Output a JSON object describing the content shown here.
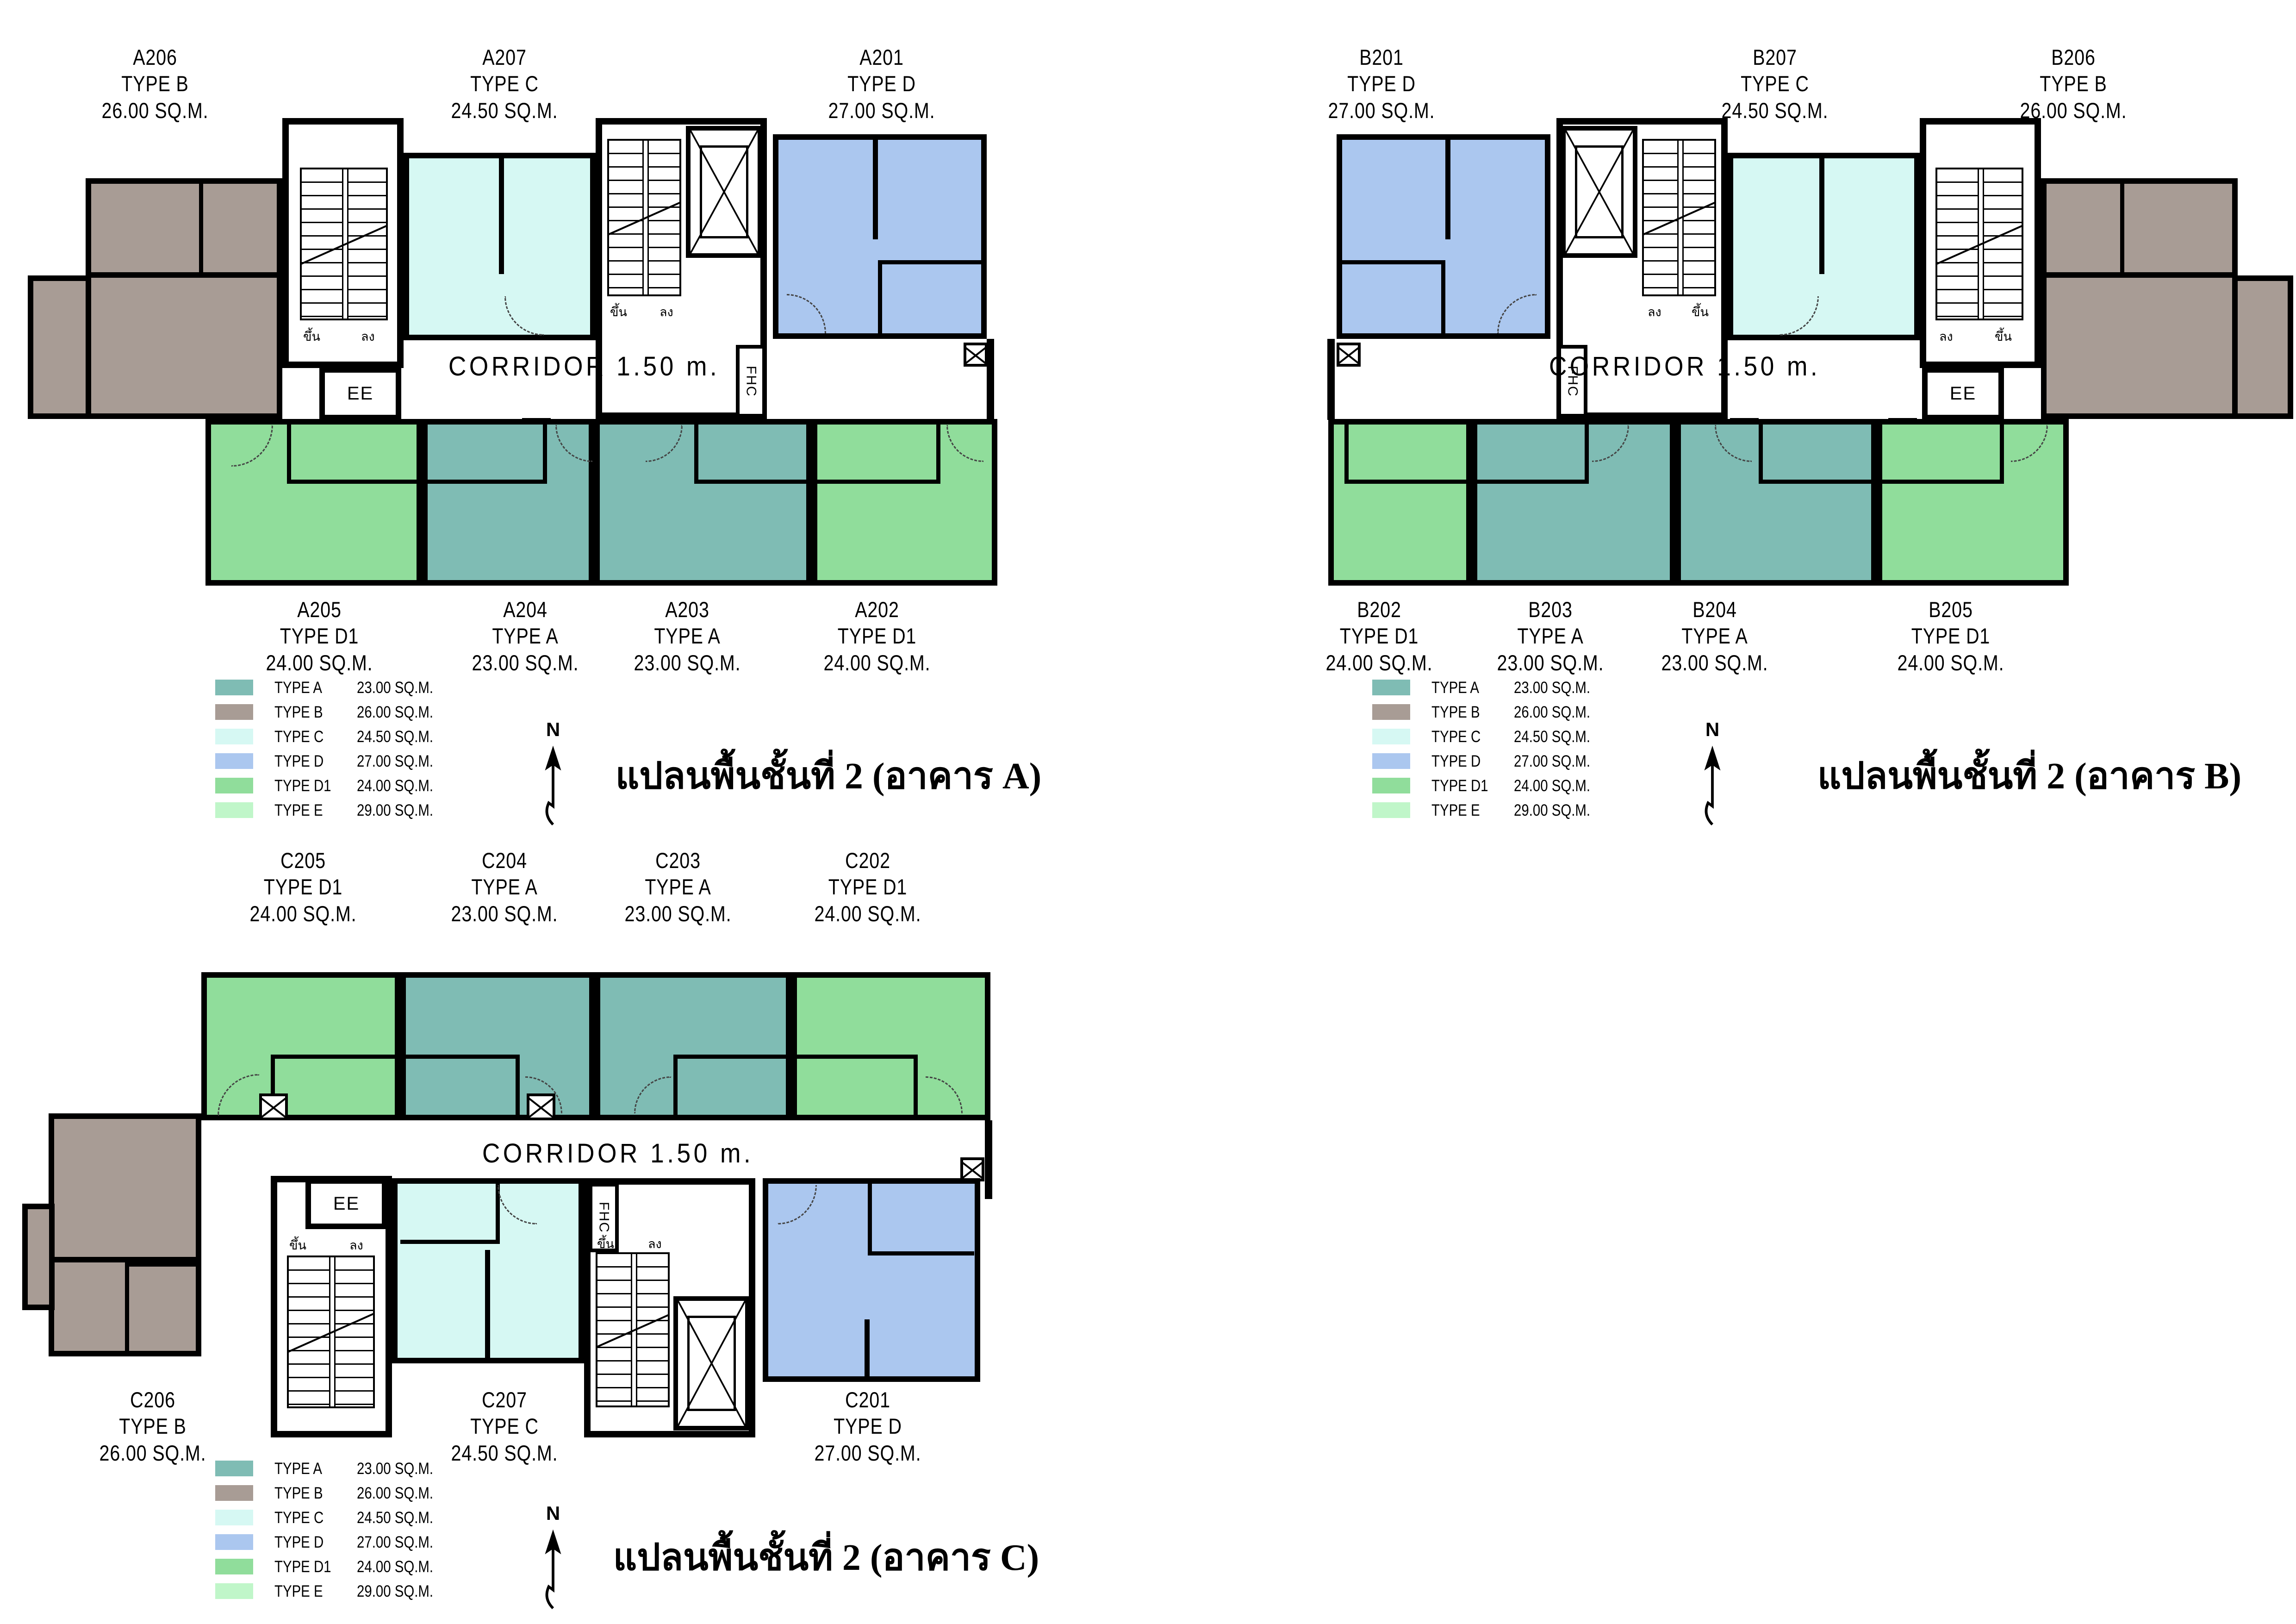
{
  "shared": {
    "corridor_label": "CORRIDOR  1.50 m.",
    "north_label": "N",
    "elevator_label": "EE",
    "fire_hose_label": "FHC",
    "stair_up_label": "ขึ้น",
    "stair_down_label": "ลง",
    "colors": {
      "type_a": "#7fbcb4",
      "type_b": "#a89c95",
      "type_c": "#d6f8f3",
      "type_d": "#abc7ef",
      "type_d1": "#90dd9b",
      "type_e": "#c0f6c9",
      "wall": "#000000",
      "background": "#ffffff"
    },
    "legend": [
      {
        "type": "TYPE A",
        "area": "23.00 SQ.M.",
        "color": "#7fbcb4"
      },
      {
        "type": "TYPE B",
        "area": "26.00 SQ.M.",
        "color": "#a89c95"
      },
      {
        "type": "TYPE C",
        "area": "24.50 SQ.M.",
        "color": "#d6f8f3"
      },
      {
        "type": "TYPE D",
        "area": "27.00 SQ.M.",
        "color": "#abc7ef"
      },
      {
        "type": "TYPE D1",
        "area": "24.00 SQ.M.",
        "color": "#90dd9b"
      },
      {
        "type": "TYPE E",
        "area": "29.00 SQ.M.",
        "color": "#c0f6c9"
      }
    ]
  },
  "plans": {
    "A": {
      "caption": "แปลนพื้นชั้นที่ 2 (อาคาร A)",
      "units": {
        "A206": {
          "no": "A206",
          "type": "TYPE B",
          "area": "26.00 SQ.M."
        },
        "A207": {
          "no": "A207",
          "type": "TYPE C",
          "area": "24.50 SQ.M."
        },
        "A201": {
          "no": "A201",
          "type": "TYPE D",
          "area": "27.00 SQ.M."
        },
        "A205": {
          "no": "A205",
          "type": "TYPE D1",
          "area": "24.00 SQ.M."
        },
        "A204": {
          "no": "A204",
          "type": "TYPE A",
          "area": "23.00 SQ.M."
        },
        "A203": {
          "no": "A203",
          "type": "TYPE A",
          "area": "23.00 SQ.M."
        },
        "A202": {
          "no": "A202",
          "type": "TYPE D1",
          "area": "24.00 SQ.M."
        }
      }
    },
    "B": {
      "caption": "แปลนพื้นชั้นที่ 2 (อาคาร B)",
      "units": {
        "B201": {
          "no": "B201",
          "type": "TYPE D",
          "area": "27.00 SQ.M."
        },
        "B207": {
          "no": "B207",
          "type": "TYPE C",
          "area": "24.50 SQ.M."
        },
        "B206": {
          "no": "B206",
          "type": "TYPE B",
          "area": "26.00 SQ.M."
        },
        "B202": {
          "no": "B202",
          "type": "TYPE D1",
          "area": "24.00 SQ.M."
        },
        "B203": {
          "no": "B203",
          "type": "TYPE A",
          "area": "23.00 SQ.M."
        },
        "B204": {
          "no": "B204",
          "type": "TYPE A",
          "area": "23.00 SQ.M."
        },
        "B205": {
          "no": "B205",
          "type": "TYPE D1",
          "area": "24.00 SQ.M."
        }
      }
    },
    "C": {
      "caption": "แปลนพื้นชั้นที่ 2 (อาคาร C)",
      "units": {
        "C205": {
          "no": "C205",
          "type": "TYPE D1",
          "area": "24.00 SQ.M."
        },
        "C204": {
          "no": "C204",
          "type": "TYPE A",
          "area": "23.00 SQ.M."
        },
        "C203": {
          "no": "C203",
          "type": "TYPE A",
          "area": "23.00 SQ.M."
        },
        "C202": {
          "no": "C202",
          "type": "TYPE D1",
          "area": "24.00 SQ.M."
        },
        "C206": {
          "no": "C206",
          "type": "TYPE B",
          "area": "26.00 SQ.M."
        },
        "C207": {
          "no": "C207",
          "type": "TYPE C",
          "area": "24.50 SQ.M."
        },
        "C201": {
          "no": "C201",
          "type": "TYPE D",
          "area": "27.00 SQ.M."
        }
      }
    }
  }
}
